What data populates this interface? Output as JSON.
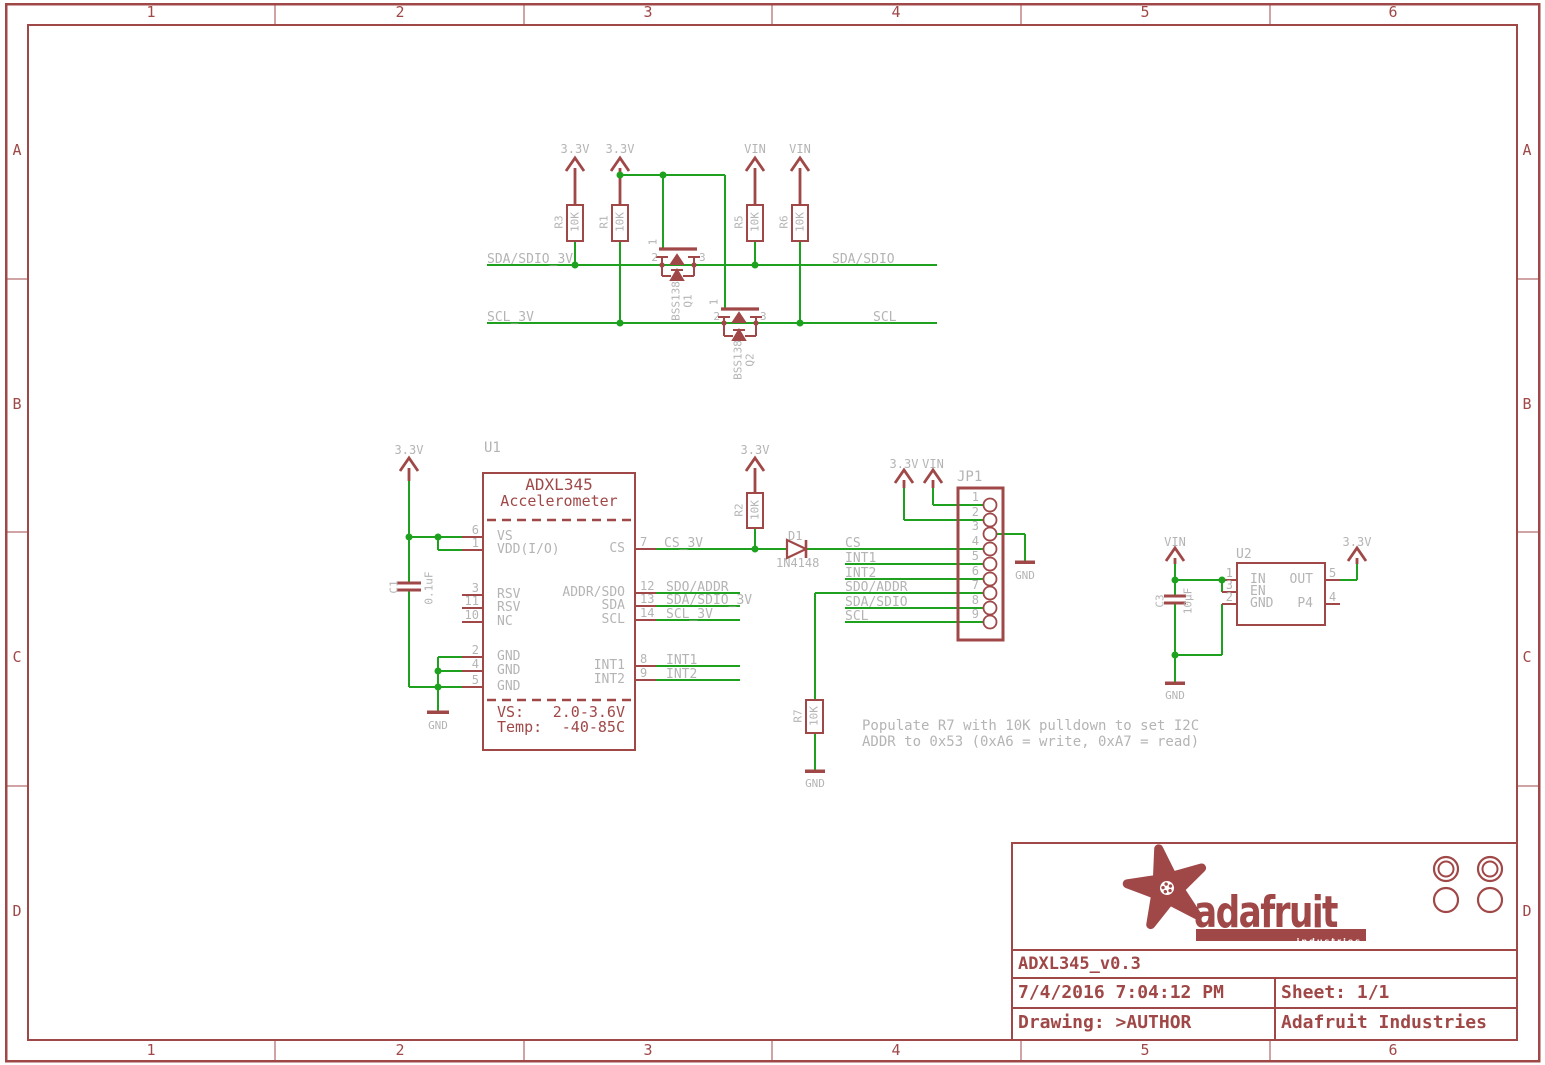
{
  "colors": {
    "symbol_red": "#a04848",
    "wire_green": "#1ea11e",
    "label_gray": "#b4b4b4",
    "background": "#ffffff"
  },
  "frame": {
    "columns": [
      "1",
      "2",
      "3",
      "4",
      "5",
      "6"
    ],
    "rows": [
      "A",
      "B",
      "C",
      "D"
    ]
  },
  "title_block": {
    "logo_text": "adafruit",
    "logo_banner_text": "industries",
    "document": "ADXL345_v0.3",
    "date": "7/4/2016 7:04:12 PM",
    "sheet": "Sheet: 1/1",
    "drawing": "Drawing: >AUTHOR",
    "company": "Adafruit Industries"
  },
  "power": {
    "v33": "3.3V",
    "vin": "VIN",
    "gnd": "GND"
  },
  "note": {
    "line1": "Populate R7 with 10K pulldown to set I2C",
    "line2": "ADDR to 0x53 (0xA6 = write, 0xA7 = read)"
  },
  "net_labels": {
    "sda_sdio_3v": "SDA/SDIO_3V",
    "sda_sdio": "SDA/SDIO",
    "scl_3v": "SCL_3V",
    "scl": "SCL",
    "cs_3v": "CS_3V",
    "cs": "CS",
    "int1": "INT1",
    "int2": "INT2",
    "sdo_addr": "SDO/ADDR"
  },
  "components": {
    "r1": {
      "ref": "R1",
      "value": "10K"
    },
    "r2": {
      "ref": "R2",
      "value": "10K"
    },
    "r3": {
      "ref": "R3",
      "value": "10K"
    },
    "r5": {
      "ref": "R5",
      "value": "10K"
    },
    "r6": {
      "ref": "R6",
      "value": "10K"
    },
    "r7": {
      "ref": "R7",
      "value": "10K"
    },
    "c1": {
      "ref": "C1",
      "value": "0.1uF"
    },
    "c3": {
      "ref": "C3",
      "value": "10µF"
    },
    "d1": {
      "ref": "D1",
      "value": "1N4148"
    },
    "q1": {
      "ref": "Q1",
      "value": "BSS138",
      "pins": [
        "1",
        "2",
        "3"
      ]
    },
    "q2": {
      "ref": "Q2",
      "value": "BSS138",
      "pins": [
        "1",
        "2",
        "3"
      ]
    },
    "u1": {
      "ref": "U1",
      "name": "ADXL345",
      "subtitle": "Accelerometer",
      "spec_vs_label": "VS:",
      "spec_vs": "2.0-3.6V",
      "spec_temp_label": "Temp:",
      "spec_temp": "-40-85C"
    },
    "u2": {
      "ref": "U2"
    },
    "jp1": {
      "ref": "JP1"
    }
  },
  "u1_pins": {
    "left": [
      {
        "num": "6",
        "name": "VS"
      },
      {
        "num": "1",
        "name": "VDD(I/O)"
      },
      {
        "num": "3",
        "name": "RSV"
      },
      {
        "num": "11",
        "name": "RSV"
      },
      {
        "num": "10",
        "name": "NC"
      },
      {
        "num": "2",
        "name": "GND"
      },
      {
        "num": "4",
        "name": "GND"
      },
      {
        "num": "5",
        "name": "GND"
      }
    ],
    "right": [
      {
        "num": "7",
        "name": "CS"
      },
      {
        "num": "12",
        "name": "ADDR/SDO"
      },
      {
        "num": "13",
        "name": "SDA"
      },
      {
        "num": "14",
        "name": "SCL"
      },
      {
        "num": "8",
        "name": "INT1"
      },
      {
        "num": "9",
        "name": "INT2"
      }
    ]
  },
  "u2_pins": {
    "left": [
      {
        "num": "1",
        "name": "IN"
      },
      {
        "num": "3",
        "name": "EN"
      },
      {
        "num": "2",
        "name": "GND"
      }
    ],
    "right": [
      {
        "num": "5",
        "name": "OUT"
      },
      {
        "num": "4",
        "name": "P4"
      }
    ]
  },
  "jp1_pins": [
    "1",
    "2",
    "3",
    "4",
    "5",
    "6",
    "7",
    "8",
    "9"
  ]
}
